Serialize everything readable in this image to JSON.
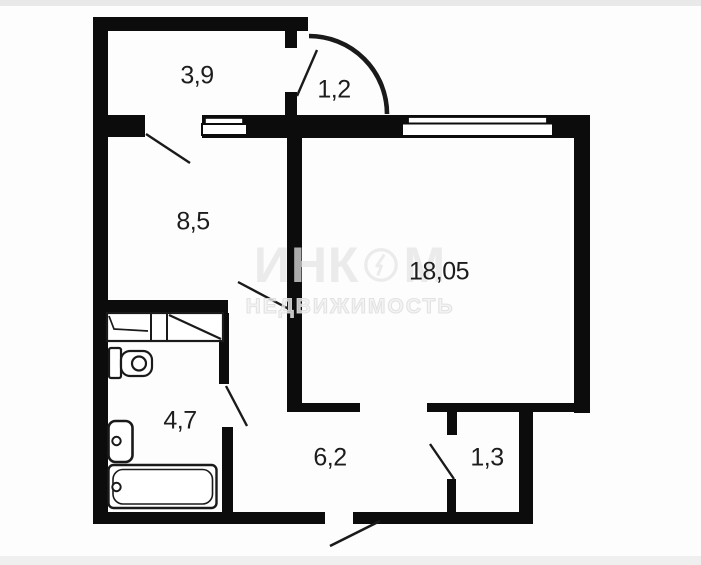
{
  "plan": {
    "type": "apartment-floor-plan",
    "rooms": [
      {
        "id": "room-top-left",
        "area_label": "3,9"
      },
      {
        "id": "room-vestibule",
        "area_label": "1,2"
      },
      {
        "id": "room-kitchen",
        "area_label": "8,5"
      },
      {
        "id": "room-living",
        "area_label": "18,05"
      },
      {
        "id": "room-bathroom",
        "area_label": "4,7"
      },
      {
        "id": "room-hallway",
        "area_label": "6,2"
      },
      {
        "id": "room-closet",
        "area_label": "1,3"
      }
    ]
  },
  "watermark": {
    "brand_line1_left": "ИНК",
    "brand_line1_right": "М",
    "brand_line2": "НЕДВИЖИМОСТЬ"
  },
  "colors": {
    "wall": "#0c0c0c",
    "line": "#1a1a1a",
    "label": "#1d1d1d",
    "background": "#fdfdfd",
    "watermark": "#e4e4e4"
  }
}
